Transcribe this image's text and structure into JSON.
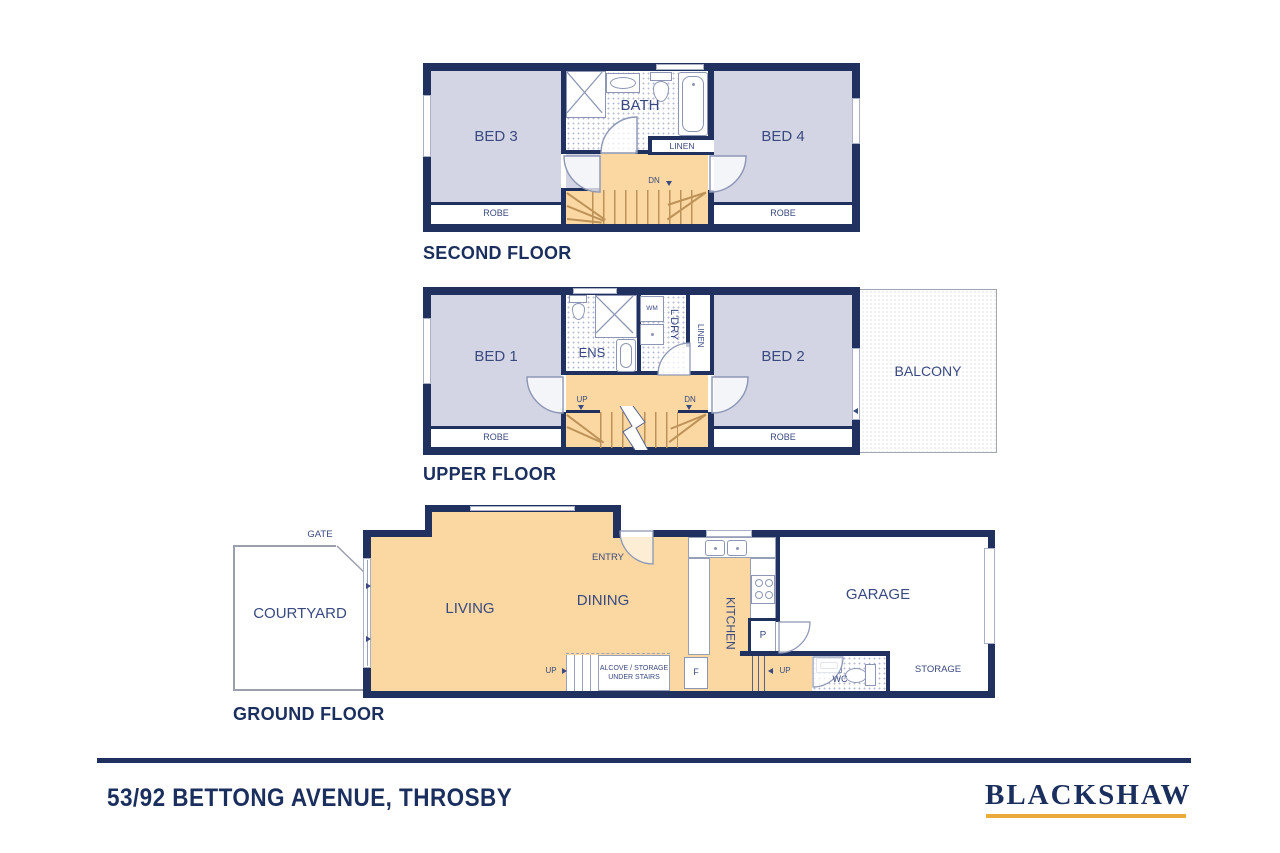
{
  "colors": {
    "wall": "#20305f",
    "bedroom_fill": "#d3d5e4",
    "floor_fill": "#fbd8a2",
    "label": "#3a4a80",
    "title": "#1b2f5e",
    "brand_underline": "#eca93c"
  },
  "floors": {
    "second": {
      "title": "SECOND FLOOR",
      "bed3": "BED 3",
      "bath": "BATH",
      "linen": "LINEN",
      "bed4": "BED 4",
      "robe_left": "ROBE",
      "robe_right": "ROBE",
      "dn": "DN"
    },
    "upper": {
      "title": "UPPER FLOOR",
      "bed1": "BED 1",
      "ens": "ENS",
      "wm": "WM",
      "ldry": "L'DRY",
      "linen": "LINEN",
      "bed2": "BED 2",
      "balcony": "BALCONY",
      "robe_left": "ROBE",
      "robe_right": "ROBE",
      "up": "UP",
      "dn": "DN"
    },
    "ground": {
      "title": "GROUND FLOOR",
      "gate": "GATE",
      "courtyard": "COURTYARD",
      "living": "LIVING",
      "dining": "DINING",
      "entry": "ENTRY",
      "kitchen": "KITCHEN",
      "pantry": "P",
      "fridge": "F",
      "up_alcove": "UP",
      "up_garage": "UP",
      "alcove_line1": "ALCOVE / STORAGE",
      "alcove_line2": "UNDER STAIRS",
      "wc": "WC",
      "garage": "GARAGE",
      "storage": "STORAGE"
    }
  },
  "footer": {
    "address": "53/92 BETTONG AVENUE, THROSBY",
    "brand": "BLACKSHAW"
  }
}
